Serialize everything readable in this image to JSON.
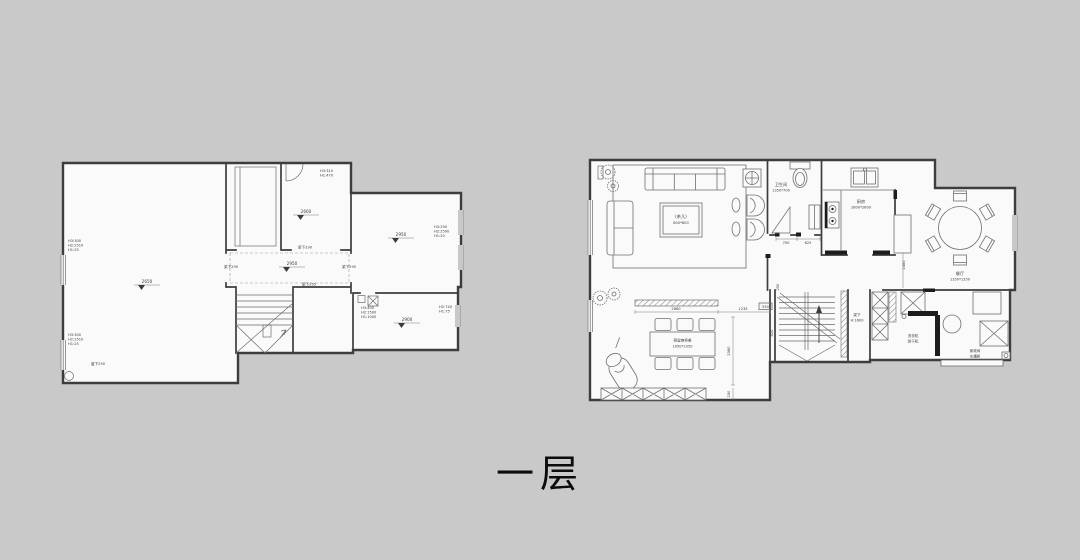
{
  "title": "一层",
  "colors": {
    "background": "#c9c9c9",
    "paper": "#fafafa",
    "line": "#3d3d3d"
  },
  "left_plan": {
    "ann_left_top": [
      "H3:300",
      "H2:2510",
      "H1:25"
    ],
    "ann_left_bottom": [
      "H3:300",
      "H2:2510",
      "H1:25"
    ],
    "ann_top_right": [
      "H3:310",
      "H1:470"
    ],
    "ann_right_room": [
      "H3:290",
      "H2:2500",
      "H1:20"
    ],
    "ann_bottom_room": [
      "H3:400",
      "H2:1500",
      "H1:1000"
    ],
    "ann_bottom_right": [
      "H2:740",
      "H1:75"
    ],
    "sill": "窗下250",
    "beam_top": "梁下290",
    "beam_left": "梁下290",
    "beam_right": "梁下295",
    "beam_bottom": "梁下295",
    "lvl_main": "2650",
    "lvl_closet": "2660",
    "lvl_corridor": "2950",
    "lvl_right": "2950",
    "lvl_bottom": "2900"
  },
  "right_plan": {
    "living_label": "(茶几)",
    "living_sub": "800*800",
    "bath_label": "卫生间",
    "bath_sub": "1350*700",
    "kitchen_label": "厨房",
    "kitchen_sub": "2800*2600",
    "dining_label": "餐厅",
    "dining_sub": "1350*1350",
    "mahjong_label": "预留麻将桌",
    "mahjong_sub": "1050*1050",
    "stair_note": "梁下",
    "stair_note_sub": "H:1600",
    "laundry_l1": "洗衣机",
    "laundry_l2": "烘干机",
    "utility_l1": "家政间",
    "utility_l2": "水槽柜",
    "dims": {
      "d700": "700",
      "d625": "625",
      "d2660": "2660",
      "d1235": "1235",
      "d550": "550",
      "d2580": "2580",
      "d250b": "250",
      "d820": "820",
      "d250s": "250",
      "d1485": "1485"
    }
  }
}
